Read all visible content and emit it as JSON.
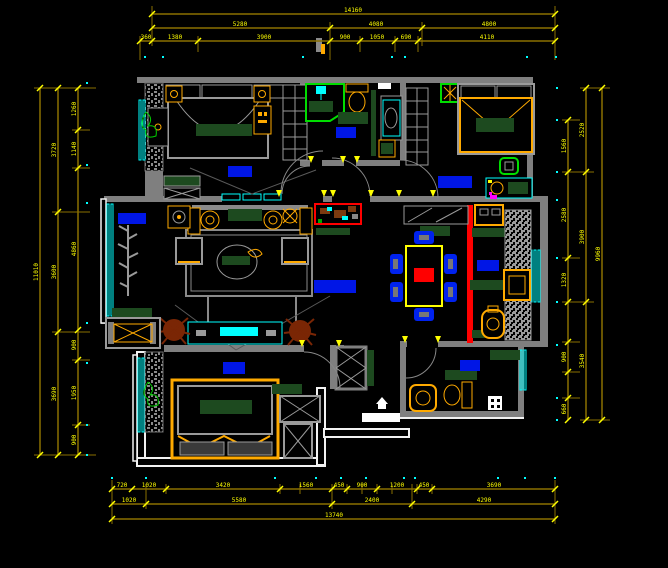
{
  "drawing": {
    "type_label": "apartment-floor-plan",
    "canvas_bg": "#000000"
  },
  "colors": {
    "wall": "#7f7f7f",
    "wall_white": "#f2f2f2",
    "dim_line": "#8a7000",
    "dim_text": "#ffff00",
    "window": "#00ffff",
    "furniture_frame": "#ffaa00",
    "room_label": "#0016e6",
    "dark_green": "#1d4a1f",
    "bright_green": "#00dd00",
    "accent_red": "#ff0000",
    "plant_brown": "#7a2605",
    "grid_dot": "#00ffff"
  },
  "dim_chains": [
    {
      "dir": "h",
      "y": 14,
      "x1": 152,
      "x2": 555,
      "ticks": [
        152,
        555
      ],
      "labels": [
        {
          "t": "14160",
          "p": 353
        }
      ]
    },
    {
      "dir": "h",
      "y": 28,
      "x1": 152,
      "x2": 555,
      "ticks": [
        152,
        330,
        422,
        555
      ],
      "labels": [
        {
          "t": "5280",
          "p": 240
        },
        {
          "t": "4080",
          "p": 376
        },
        {
          "t": "4800",
          "p": 489
        }
      ]
    },
    {
      "dir": "h",
      "y": 41,
      "x1": 140,
      "x2": 555,
      "ticks": [
        140,
        152,
        198,
        330,
        360,
        395,
        418,
        555
      ],
      "labels": [
        {
          "t": "360",
          "p": 146
        },
        {
          "t": "1380",
          "p": 175
        },
        {
          "t": "3900",
          "p": 264
        },
        {
          "t": "900",
          "p": 345
        },
        {
          "t": "1050",
          "p": 377
        },
        {
          "t": "690",
          "p": 406
        },
        {
          "t": "4110",
          "p": 487
        }
      ]
    },
    {
      "dir": "h",
      "y": 489,
      "x1": 112,
      "x2": 555,
      "ticks": [
        112,
        132,
        166,
        280,
        332,
        347,
        377,
        417,
        432,
        555
      ],
      "labels": [
        {
          "t": "720",
          "p": 122
        },
        {
          "t": "1020",
          "p": 149
        },
        {
          "t": "3420",
          "p": 223
        },
        {
          "t": "1560",
          "p": 306
        },
        {
          "t": "450",
          "p": 339
        },
        {
          "t": "900",
          "p": 362
        },
        {
          "t": "1200",
          "p": 397
        },
        {
          "t": "450",
          "p": 424
        },
        {
          "t": "3690",
          "p": 494
        }
      ]
    },
    {
      "dir": "h",
      "y": 504,
      "x1": 112,
      "x2": 555,
      "ticks": [
        112,
        146,
        332,
        412,
        555
      ],
      "labels": [
        {
          "t": "1020",
          "p": 129
        },
        {
          "t": "5580",
          "p": 239
        },
        {
          "t": "2400",
          "p": 372
        },
        {
          "t": "4290",
          "p": 484
        }
      ]
    },
    {
      "dir": "h",
      "y": 519,
      "x1": 112,
      "x2": 555,
      "ticks": [
        112,
        555
      ],
      "labels": [
        {
          "t": "13740",
          "p": 334
        }
      ]
    },
    {
      "dir": "v",
      "x": 78,
      "y1": 88,
      "y2": 455,
      "ticks": [
        88,
        130,
        168,
        330,
        360,
        425,
        455
      ],
      "labels": [
        {
          "t": "1260",
          "p": 109
        },
        {
          "t": "1140",
          "p": 149
        },
        {
          "t": "4860",
          "p": 249
        },
        {
          "t": "900",
          "p": 345
        },
        {
          "t": "1950",
          "p": 393
        },
        {
          "t": "900",
          "p": 440
        }
      ]
    },
    {
      "dir": "v",
      "x": 58,
      "y1": 88,
      "y2": 455,
      "ticks": [
        88,
        212,
        332,
        455
      ],
      "labels": [
        {
          "t": "3720",
          "p": 150
        },
        {
          "t": "3600",
          "p": 272
        },
        {
          "t": "3690",
          "p": 394
        }
      ]
    },
    {
      "dir": "v",
      "x": 40,
      "y1": 88,
      "y2": 455,
      "ticks": [
        88,
        455
      ],
      "labels": [
        {
          "t": "11010",
          "p": 272
        }
      ]
    },
    {
      "dir": "v",
      "x": 568,
      "y1": 120,
      "y2": 420,
      "ticks": [
        120,
        172,
        258,
        302,
        342,
        372,
        398,
        420
      ],
      "labels": [
        {
          "t": "1560",
          "p": 146
        },
        {
          "t": "2580",
          "p": 215
        },
        {
          "t": "1320",
          "p": 280
        },
        {
          "t": "900",
          "p": 357
        },
        {
          "t": "660",
          "p": 409
        }
      ]
    },
    {
      "dir": "v",
      "x": 586,
      "y1": 88,
      "y2": 420,
      "ticks": [
        88,
        172,
        302,
        420
      ],
      "labels": [
        {
          "t": "2520",
          "p": 130
        },
        {
          "t": "3900",
          "p": 237
        },
        {
          "t": "3540",
          "p": 361
        }
      ]
    },
    {
      "dir": "v",
      "x": 602,
      "y1": 88,
      "y2": 420,
      "ticks": [
        88,
        420
      ],
      "labels": [
        {
          "t": "9960",
          "p": 254
        }
      ]
    }
  ],
  "ext_lines": [
    [
      152,
      6,
      152,
      46
    ],
    [
      330,
      22,
      330,
      60
    ],
    [
      422,
      22,
      422,
      46
    ],
    [
      555,
      6,
      555,
      60
    ],
    [
      140,
      36,
      140,
      60
    ],
    [
      395,
      36,
      395,
      52
    ],
    [
      418,
      36,
      418,
      52
    ],
    [
      198,
      36,
      198,
      52
    ],
    [
      360,
      36,
      360,
      52
    ],
    [
      34,
      88,
      96,
      88
    ],
    [
      34,
      455,
      96,
      455
    ],
    [
      52,
      212,
      90,
      212
    ],
    [
      52,
      332,
      90,
      332
    ],
    [
      72,
      130,
      90,
      130
    ],
    [
      72,
      168,
      90,
      168
    ],
    [
      72,
      360,
      90,
      360
    ],
    [
      72,
      425,
      90,
      425
    ],
    [
      562,
      120,
      580,
      120
    ],
    [
      562,
      172,
      594,
      172
    ],
    [
      562,
      258,
      580,
      258
    ],
    [
      562,
      302,
      594,
      302
    ],
    [
      562,
      342,
      580,
      342
    ],
    [
      562,
      372,
      580,
      372
    ],
    [
      562,
      398,
      580,
      398
    ],
    [
      580,
      88,
      610,
      88
    ],
    [
      580,
      420,
      610,
      420
    ],
    [
      112,
      480,
      112,
      524
    ],
    [
      555,
      480,
      555,
      524
    ],
    [
      146,
      484,
      146,
      509
    ],
    [
      332,
      484,
      332,
      509
    ],
    [
      412,
      484,
      412,
      509
    ],
    [
      166,
      484,
      166,
      494
    ],
    [
      280,
      484,
      280,
      494
    ],
    [
      377,
      484,
      377,
      494
    ],
    [
      432,
      484,
      432,
      494
    ],
    [
      300,
      484,
      300,
      494
    ],
    [
      347,
      484,
      347,
      494
    ],
    [
      362,
      484,
      362,
      494
    ],
    [
      392,
      484,
      392,
      494
    ],
    [
      417,
      484,
      417,
      494
    ]
  ],
  "grid_dots": [
    [
      145,
      57
    ],
    [
      163,
      57
    ],
    [
      303,
      57
    ],
    [
      392,
      57
    ],
    [
      405,
      57
    ],
    [
      527,
      57
    ],
    [
      556,
      57
    ],
    [
      87,
      83
    ],
    [
      87,
      165
    ],
    [
      87,
      203
    ],
    [
      87,
      323
    ],
    [
      87,
      363
    ],
    [
      87,
      425
    ],
    [
      87,
      455
    ],
    [
      557,
      88
    ],
    [
      557,
      120
    ],
    [
      557,
      172
    ],
    [
      557,
      200
    ],
    [
      557,
      258
    ],
    [
      557,
      302
    ],
    [
      557,
      345
    ],
    [
      557,
      398
    ],
    [
      557,
      420
    ],
    [
      112,
      478
    ],
    [
      146,
      478
    ],
    [
      275,
      478
    ],
    [
      316,
      478
    ],
    [
      341,
      478
    ],
    [
      366,
      478
    ],
    [
      404,
      478
    ],
    [
      415,
      478
    ],
    [
      498,
      478
    ],
    [
      525,
      478
    ],
    [
      555,
      478
    ]
  ]
}
